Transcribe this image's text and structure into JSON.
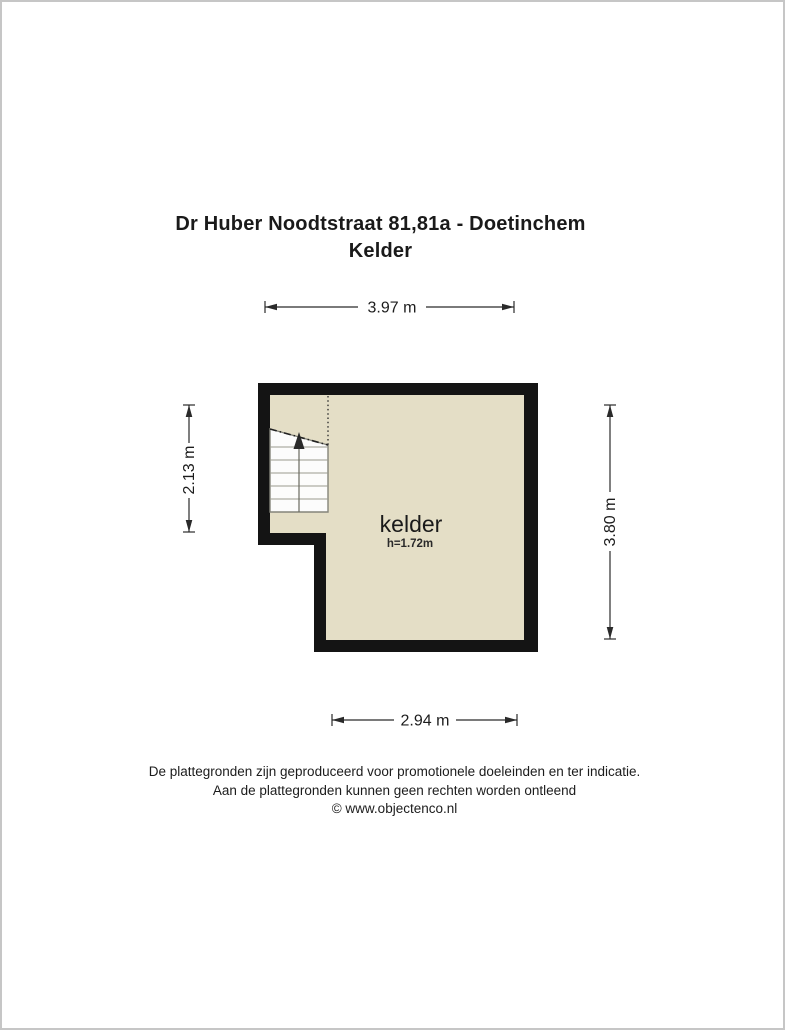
{
  "header": {
    "title_line1": "Dr Huber Noodtstraat 81,81a - Doetinchem",
    "title_line2": "Kelder"
  },
  "floorplan": {
    "room": {
      "label": "kelder",
      "height_label": "h=1.72m"
    },
    "dimensions": {
      "top": "3.97 m",
      "left": "2.13 m",
      "right": "3.80 m",
      "bottom": "2.94 m"
    },
    "colors": {
      "wall": "#141414",
      "floor": "#e4dec6",
      "stairs_fill": "#fcfcfc",
      "dimension_line": "#2a2a2a",
      "frame_border": "#c6c6c6"
    }
  },
  "footer": {
    "line1": "De plattegronden zijn geproduceerd voor promotionele doeleinden en ter indicatie.",
    "line2": "Aan de plattegronden kunnen geen rechten worden ontleend",
    "line3": "© www.objectenco.nl"
  }
}
